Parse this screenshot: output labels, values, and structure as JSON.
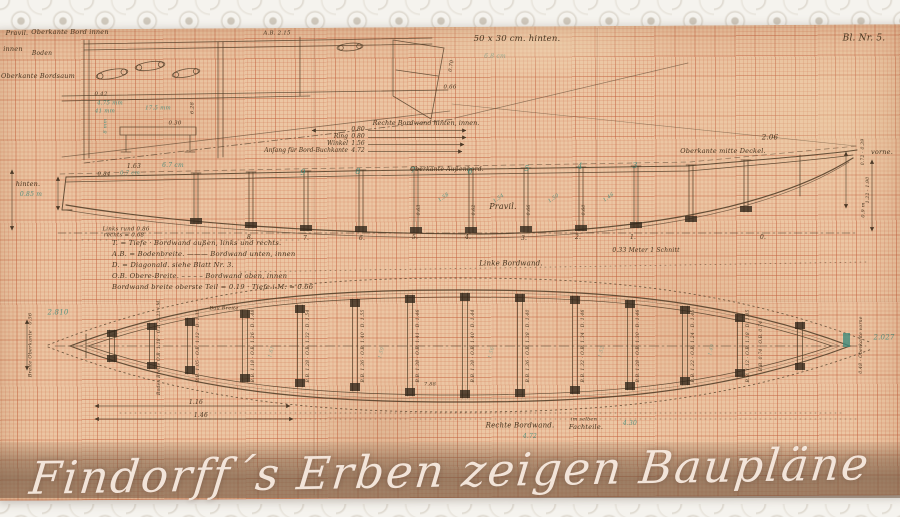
{
  "page": {
    "sheet_number": "Bl. Nr. 5.",
    "overlay_title": "Findorff´s Erben zeigen Baupläne"
  },
  "measure_list": {
    "title": "Rechte Bordwand hinten, innen.",
    "rows": [
      {
        "label": "",
        "value": "0.80"
      },
      {
        "label": "Ring",
        "value": "0.80"
      },
      {
        "label": "Winkel",
        "value": "1.56"
      },
      {
        "label": "Anfang für Bord-Buchkante",
        "value": "4.72"
      }
    ]
  },
  "legend": {
    "lines": [
      "T. = Tiefe · Bordwand außen, links und rechts.",
      "A.B. = Bodenbreite. ——— Bordwand unten, innen",
      "D. = Diagonald. siehe Blatt Nr. 3.",
      "O.B. Obere-Breite. – – – – Bordwand oben, innen",
      "Bordwand breite oberste Teil = 0.19 · Tiefe i.M. = 0.66"
    ]
  },
  "annotations": [
    {
      "text": "Pravil.",
      "x": 17,
      "y": 33,
      "s": 6.5,
      "n": "label-pravil-top"
    },
    {
      "text": "Oberkante Bord innen",
      "x": 70,
      "y": 32,
      "s": 6.5,
      "n": "label-oberkante-bord-innen"
    },
    {
      "text": "innen",
      "x": 13,
      "y": 49,
      "s": 6.5
    },
    {
      "text": "Boden",
      "x": 42,
      "y": 54,
      "s": 6
    },
    {
      "text": "Oberkante Bordsaum",
      "x": 38,
      "y": 76,
      "s": 6.5,
      "n": "label-oberkante-bordsaum"
    },
    {
      "text": "A.B. 2.15",
      "x": 277,
      "y": 34,
      "s": 5.5
    },
    {
      "text": "0.42",
      "x": 101,
      "y": 95,
      "s": 5.5
    },
    {
      "text": "4.75 mm",
      "x": 110,
      "y": 104,
      "s": 5.5,
      "c": "teal"
    },
    {
      "text": "41 mm",
      "x": 105,
      "y": 112,
      "s": 5.5,
      "c": "teal"
    },
    {
      "text": "17.5 mm",
      "x": 158,
      "y": 109,
      "s": 5.5,
      "c": "teal"
    },
    {
      "text": "0.30",
      "x": 175,
      "y": 124,
      "s": 5.5
    },
    {
      "text": "6.28",
      "x": 193,
      "y": 108,
      "s": 5,
      "r": -90
    },
    {
      "text": "8 mm",
      "x": 106,
      "y": 126,
      "s": 5,
      "c": "teal",
      "r": -90
    },
    {
      "text": "0.70",
      "x": 452,
      "y": 66,
      "s": 5,
      "r": -80
    },
    {
      "text": "0.66",
      "x": 450,
      "y": 88,
      "s": 5.5
    },
    {
      "text": "50 x 30 cm. hinten.",
      "x": 517,
      "y": 39,
      "s": 8.5,
      "n": "paper-size-note"
    },
    {
      "text": "6.8 cm",
      "x": 495,
      "y": 57,
      "s": 6,
      "c": "teal faint"
    },
    {
      "text": "Bl. Nr. 5.",
      "x": 864,
      "y": 39,
      "s": 9,
      "n": "sheet-number"
    },
    {
      "text": "hinten.",
      "x": 28,
      "y": 184,
      "s": 6.5,
      "n": "label-hinten"
    },
    {
      "text": "0.85 m",
      "x": 31,
      "y": 195,
      "s": 6,
      "c": "teal"
    },
    {
      "text": "1.63",
      "x": 134,
      "y": 167,
      "s": 6
    },
    {
      "text": "6.7 cm",
      "x": 173,
      "y": 166,
      "s": 6,
      "c": "teal"
    },
    {
      "text": "0.84",
      "x": 104,
      "y": 175,
      "s": 5.5
    },
    {
      "text": "0.7 cm",
      "x": 130,
      "y": 174,
      "s": 5.5,
      "c": "teal"
    },
    {
      "text": "Oberkante Außenbord.",
      "x": 447,
      "y": 170,
      "s": 6,
      "n": "label-oberkante-aussenbord"
    },
    {
      "text": "Pravil.",
      "x": 503,
      "y": 207,
      "s": 8,
      "n": "label-pravil-profile"
    },
    {
      "text": "Oberkante mitte Deckel.",
      "x": 723,
      "y": 151,
      "s": 6.5,
      "n": "label-oberkante-mitte-deckel"
    },
    {
      "text": "2.06",
      "x": 770,
      "y": 138,
      "s": 7
    },
    {
      "text": "vorne.",
      "x": 882,
      "y": 152,
      "s": 6.5,
      "n": "label-vorne"
    },
    {
      "text": "0.33 Meter 1 Schnitt",
      "x": 646,
      "y": 251,
      "s": 6,
      "n": "scale-note"
    },
    {
      "text": "Links rund 0.86",
      "x": 126,
      "y": 230,
      "s": 5.5
    },
    {
      "text": "rechts = 0.68",
      "x": 124,
      "y": 236,
      "s": 5.5
    },
    {
      "text": "9",
      "x": 303,
      "y": 173,
      "s": 8,
      "c": "teal",
      "n": "station-number-pencil"
    },
    {
      "text": "8",
      "x": 358,
      "y": 172,
      "s": 8,
      "c": "teal",
      "n": "station-number-pencil"
    },
    {
      "text": "7",
      "x": 413,
      "y": 171,
      "s": 8,
      "c": "teal",
      "n": "station-number-pencil"
    },
    {
      "text": "6",
      "x": 470,
      "y": 172,
      "s": 8,
      "c": "teal",
      "n": "station-number-pencil"
    },
    {
      "text": "5",
      "x": 527,
      "y": 169,
      "s": 8,
      "c": "teal",
      "n": "station-number-pencil"
    },
    {
      "text": "4",
      "x": 580,
      "y": 167,
      "s": 8,
      "c": "teal",
      "n": "station-number-pencil"
    },
    {
      "text": "3",
      "x": 635,
      "y": 166,
      "s": 8,
      "c": "teal",
      "n": "station-number-pencil"
    },
    {
      "text": "8.",
      "x": 250,
      "y": 238,
      "s": 6,
      "n": "station-number-ink"
    },
    {
      "text": "7.",
      "x": 306,
      "y": 239,
      "s": 6,
      "n": "station-number-ink"
    },
    {
      "text": "6.",
      "x": 362,
      "y": 239,
      "s": 6,
      "n": "station-number-ink"
    },
    {
      "text": "5.",
      "x": 415,
      "y": 238,
      "s": 6,
      "n": "station-number-ink"
    },
    {
      "text": "4.",
      "x": 468,
      "y": 238,
      "s": 6,
      "n": "station-number-ink"
    },
    {
      "text": "3.",
      "x": 524,
      "y": 239,
      "s": 6,
      "n": "station-number-ink"
    },
    {
      "text": "2.",
      "x": 578,
      "y": 238,
      "s": 6,
      "n": "station-number-ink"
    },
    {
      "text": "1.",
      "x": 633,
      "y": 238,
      "s": 6,
      "n": "station-number-ink"
    },
    {
      "text": "0.",
      "x": 763,
      "y": 238,
      "s": 6,
      "n": "station-number-ink"
    },
    {
      "text": "0.72 · 0.39",
      "x": 864,
      "y": 152,
      "s": 4.5,
      "r": -90
    },
    {
      "text": "1.22 · 1.90",
      "x": 869,
      "y": 190,
      "s": 4.5,
      "r": -90
    },
    {
      "text": "0.9 m",
      "x": 864,
      "y": 210,
      "s": 5,
      "r": -90
    },
    {
      "text": "0.63",
      "x": 420,
      "y": 210,
      "s": 4.5,
      "r": -90
    },
    {
      "text": "0.62",
      "x": 475,
      "y": 210,
      "s": 4.5,
      "r": -90
    },
    {
      "text": "0.66",
      "x": 530,
      "y": 210,
      "s": 4.5,
      "r": -90
    },
    {
      "text": "0.60",
      "x": 585,
      "y": 210,
      "s": 4.5,
      "r": -90
    },
    {
      "text": "1.58",
      "x": 444,
      "y": 198,
      "s": 5,
      "c": "teal",
      "r": -35
    },
    {
      "text": "1.54",
      "x": 499,
      "y": 199,
      "s": 5,
      "c": "teal",
      "r": -35
    },
    {
      "text": "1.50",
      "x": 554,
      "y": 199,
      "s": 5,
      "c": "teal",
      "r": -35
    },
    {
      "text": "1.46",
      "x": 609,
      "y": 198,
      "s": 5,
      "c": "teal",
      "r": -35
    },
    {
      "text": "Linke Bordwand.",
      "x": 511,
      "y": 264,
      "s": 7,
      "n": "label-linke-bordwand"
    },
    {
      "text": "2.810",
      "x": 58,
      "y": 313,
      "s": 7,
      "c": "teal"
    },
    {
      "text": "2.027",
      "x": 884,
      "y": 338,
      "s": 7,
      "c": "teal"
    },
    {
      "text": "Breite Oberkante · 0.56",
      "x": 31,
      "y": 345,
      "s": 5,
      "r": -90
    },
    {
      "text": "Boden Breite O.B. 1.18 · O.B. 1.23 i.M.",
      "x": 160,
      "y": 347,
      "s": 4.5,
      "r": -90,
      "n": "plan-frame-label"
    },
    {
      "text": "Bau Breite",
      "x": 224,
      "y": 309,
      "s": 5
    },
    {
      "text": "B.B. 0.74 · O.B. 0.74",
      "x": 762,
      "y": 346,
      "s": 4.5,
      "r": -90,
      "n": "plan-frame-label"
    },
    {
      "text": "0.48 · Oberkante vorne",
      "x": 862,
      "y": 345,
      "s": 4.5,
      "r": -90
    },
    {
      "text": "B.B. 1.05 · O.B. 1.12 · D. 1.35",
      "x": 199,
      "y": 346,
      "s": 4.5,
      "r": -90,
      "n": "plan-frame-label"
    },
    {
      "text": "B.B. 1.18 · O.B. 1.26 · D. 1.48",
      "x": 254,
      "y": 346,
      "s": 4.5,
      "r": -90,
      "n": "plan-frame-label"
    },
    {
      "text": "B.B. 1.28 · O.B. 1.32 · D. 1.54",
      "x": 309,
      "y": 346,
      "s": 4.5,
      "r": -90,
      "n": "plan-frame-label"
    },
    {
      "text": "B.B. 1.36 · O.B. 1.40 · D. 1.55",
      "x": 364,
      "y": 346,
      "s": 4.5,
      "r": -90,
      "n": "plan-frame-label"
    },
    {
      "text": "B.B. 1.38 · O.B. 1.41 · D. 1.46",
      "x": 419,
      "y": 346,
      "s": 4.5,
      "r": -90,
      "n": "plan-frame-label"
    },
    {
      "text": "B.B. 1.38 · O.B. 1.40 · D. 1.44",
      "x": 474,
      "y": 346,
      "s": 4.5,
      "r": -90,
      "n": "plan-frame-label"
    },
    {
      "text": "B.B. 1.36 · O.B. 1.38 · D. 1.40",
      "x": 529,
      "y": 346,
      "s": 4.5,
      "r": -90,
      "n": "plan-frame-label"
    },
    {
      "text": "B.B. 1.32 · O.B. 1.34 · D. 1.46",
      "x": 584,
      "y": 346,
      "s": 4.5,
      "r": -90,
      "n": "plan-frame-label"
    },
    {
      "text": "B.B. 1.28 · O.B. 1.30 · D. 1.46",
      "x": 639,
      "y": 346,
      "s": 4.5,
      "r": -90,
      "n": "plan-frame-label"
    },
    {
      "text": "B.B. 1.22 · O.B. 1.24 · D. 1.45",
      "x": 694,
      "y": 346,
      "s": 4.5,
      "r": -90,
      "n": "plan-frame-label"
    },
    {
      "text": "B.B. 1.12 · O.B. 1.18 · D. 1.45",
      "x": 749,
      "y": 346,
      "s": 4.5,
      "r": -90,
      "n": "plan-frame-label"
    },
    {
      "text": "1.61",
      "x": 272,
      "y": 352,
      "s": 5,
      "c": "teal faint",
      "r": -75
    },
    {
      "text": "1.59",
      "x": 382,
      "y": 353,
      "s": 5,
      "c": "teal faint",
      "r": -75
    },
    {
      "text": "1.56",
      "x": 492,
      "y": 353,
      "s": 5,
      "c": "teal faint",
      "r": -75
    },
    {
      "text": "1.52",
      "x": 602,
      "y": 352,
      "s": 5,
      "c": "teal faint",
      "r": -75
    },
    {
      "text": "1.49",
      "x": 712,
      "y": 350,
      "s": 5,
      "c": "teal faint",
      "r": -75
    },
    {
      "text": "Rechte Bordwand.",
      "x": 520,
      "y": 426,
      "s": 7,
      "n": "label-rechte-bordwand"
    },
    {
      "text": "im selben",
      "x": 584,
      "y": 420,
      "s": 5
    },
    {
      "text": "Fachteile.",
      "x": 586,
      "y": 427,
      "s": 6.5,
      "n": "label-fachteile"
    },
    {
      "text": "4.72",
      "x": 530,
      "y": 437,
      "s": 6,
      "c": "teal"
    },
    {
      "text": "4.30",
      "x": 630,
      "y": 424,
      "s": 6,
      "c": "teal"
    },
    {
      "text": "1.16",
      "x": 196,
      "y": 403,
      "s": 6
    },
    {
      "text": "1.46",
      "x": 201,
      "y": 416,
      "s": 6
    },
    {
      "text": "7.88",
      "x": 430,
      "y": 385,
      "s": 5
    }
  ]
}
